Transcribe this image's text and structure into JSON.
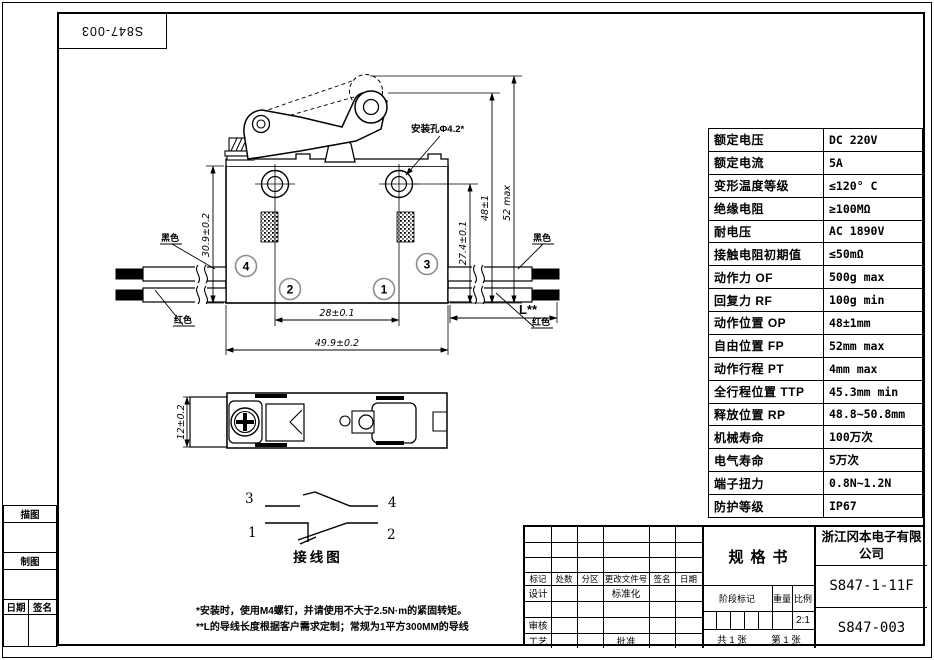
{
  "page": {
    "stamp_top": "S847-003",
    "notes": [
      "*安装时，使用M4螺钉，并请使用不大于2.5N·m的紧固转矩。",
      "**L的导线长度根据客户需求定制；常规为1平方300MM的导线"
    ]
  },
  "left_sidebar": {
    "trace_label": "描图",
    "draft_label": "制图",
    "date_label": "日期",
    "sign_label": "签名"
  },
  "spec_table": {
    "rows": [
      {
        "label": "额定电压",
        "value": "DC 220V"
      },
      {
        "label": "额定电流",
        "value": "5A"
      },
      {
        "label": "变形温度等级",
        "value": "≤120° C"
      },
      {
        "label": "绝缘电阻",
        "value": "≥100MΩ"
      },
      {
        "label": "耐电压",
        "value": "AC 1890V"
      },
      {
        "label": "接触电阻初期值",
        "value": "≤50mΩ"
      },
      {
        "label": "动作力 OF",
        "value": "500g max"
      },
      {
        "label": "回复力 RF",
        "value": "100g min"
      },
      {
        "label": "动作位置 OP",
        "value": "48±1mm"
      },
      {
        "label": "自由位置 FP",
        "value": "52mm max"
      },
      {
        "label": "动作行程 PT",
        "value": "4mm max"
      },
      {
        "label": "全行程位置 TTP",
        "value": "45.3mm min"
      },
      {
        "label": "释放位置 RP",
        "value": "48.8~50.8mm"
      },
      {
        "label": "机械寿命",
        "value": "100万次"
      },
      {
        "label": "电气寿命",
        "value": "5万次"
      },
      {
        "label": "端子扭力",
        "value": "0.8N~1.2N"
      },
      {
        "label": "防护等级",
        "value": "IP67"
      }
    ]
  },
  "drawing": {
    "front_view": {
      "dim_height_left": "30.9±0.2",
      "dim_hole_pitch": "28±0.1",
      "dim_width": "49.9±0.2",
      "dim_terminal_height": "27.4±0.1",
      "dim_op": "48±1",
      "dim_free": "52 max",
      "mount_hole_label": "安装孔Φ4.2*",
      "wire_black": "黑色",
      "wire_red": "红色",
      "wire_length": "L**",
      "terminals": [
        "4",
        "3",
        "2",
        "1"
      ]
    },
    "side_view": {
      "dim_height": "12±0.2"
    },
    "wiring": {
      "title": "接线图",
      "terminals": [
        "3",
        "4",
        "1",
        "2"
      ]
    }
  },
  "title_block": {
    "header_cols": [
      "标记",
      "处数",
      "分区",
      "更改文件号",
      "签名",
      "日期"
    ],
    "design_label": "设计",
    "standard_label": "标准化",
    "review_label": "审核",
    "process_label": "工艺",
    "approve_label": "批准",
    "spec_title": "规格书",
    "stage_label": "阶段标记",
    "weight_label": "重量",
    "scale_label": "比例",
    "scale_value": "2:1",
    "sheets_total": "共 1 张",
    "sheet_no": "第 1 张",
    "company": "浙江冈本电子有限公司",
    "part_no": "S847-1-11F",
    "drawing_no": "S847-003"
  }
}
